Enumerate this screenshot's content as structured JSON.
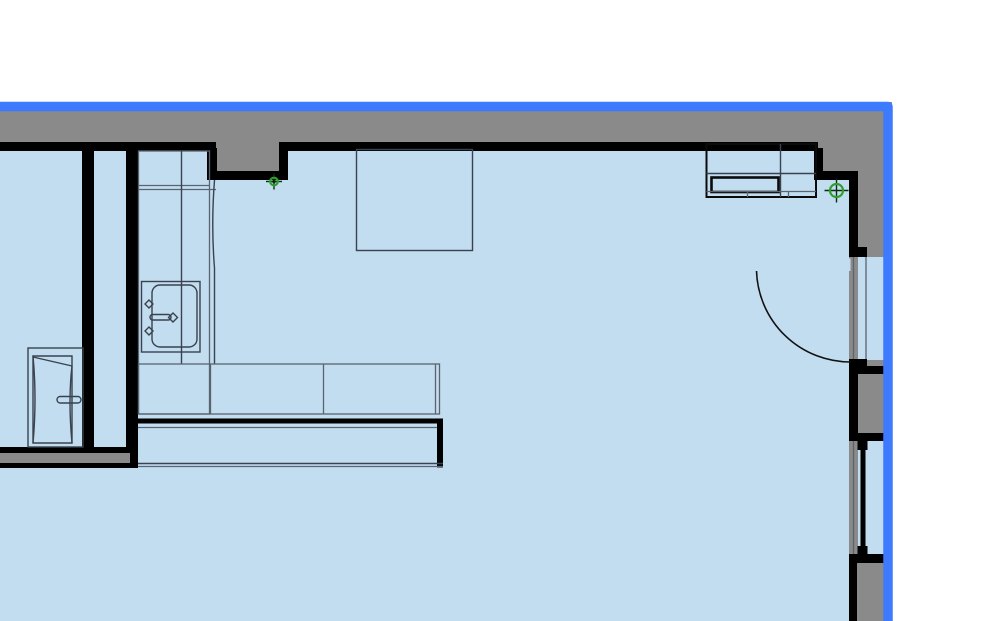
{
  "meta": {
    "view": "floor-plan-crop",
    "canvas": {
      "width": 1000,
      "height": 621
    },
    "visible_text": ""
  },
  "colors": {
    "bg": "#ffffff",
    "paper": "#8a8a8a",
    "room": "#c2dcf0",
    "wall": "#000000",
    "outline": "#39424d",
    "outline_soft": "#5a6470",
    "sel": "#3d7afd",
    "marker_green": "#2f9e2f",
    "marker_dark": "#0c2d0c"
  },
  "selection_frame": {
    "sides": [
      "top",
      "right"
    ],
    "color": "#3d7afd",
    "thickness_px": 9
  },
  "markers": [
    {
      "name": "placement-marker-1",
      "x": 274,
      "y": 181.5,
      "ring_radius": 3.8,
      "arm_length": 8,
      "center_dot": true
    },
    {
      "name": "placement-marker-2",
      "x": 836.5,
      "y": 190.5,
      "ring_radius": 6.5,
      "arm_length": 12,
      "center_dot": false
    }
  ],
  "elements": {
    "rooms": [
      {
        "name": "side-room"
      },
      {
        "name": "hallway"
      },
      {
        "name": "main-room"
      }
    ],
    "fixtures": [
      {
        "name": "kitchen-counter-with-sink"
      },
      {
        "name": "kitchen-sink"
      },
      {
        "name": "kitchen-lower-counter-row"
      },
      {
        "name": "kitchen-island"
      },
      {
        "name": "tall-unit-side-room"
      },
      {
        "name": "wall-cabinet-top-right"
      },
      {
        "name": "table"
      },
      {
        "name": "balcony-door"
      },
      {
        "name": "window"
      },
      {
        "name": "wall-recess"
      }
    ]
  }
}
